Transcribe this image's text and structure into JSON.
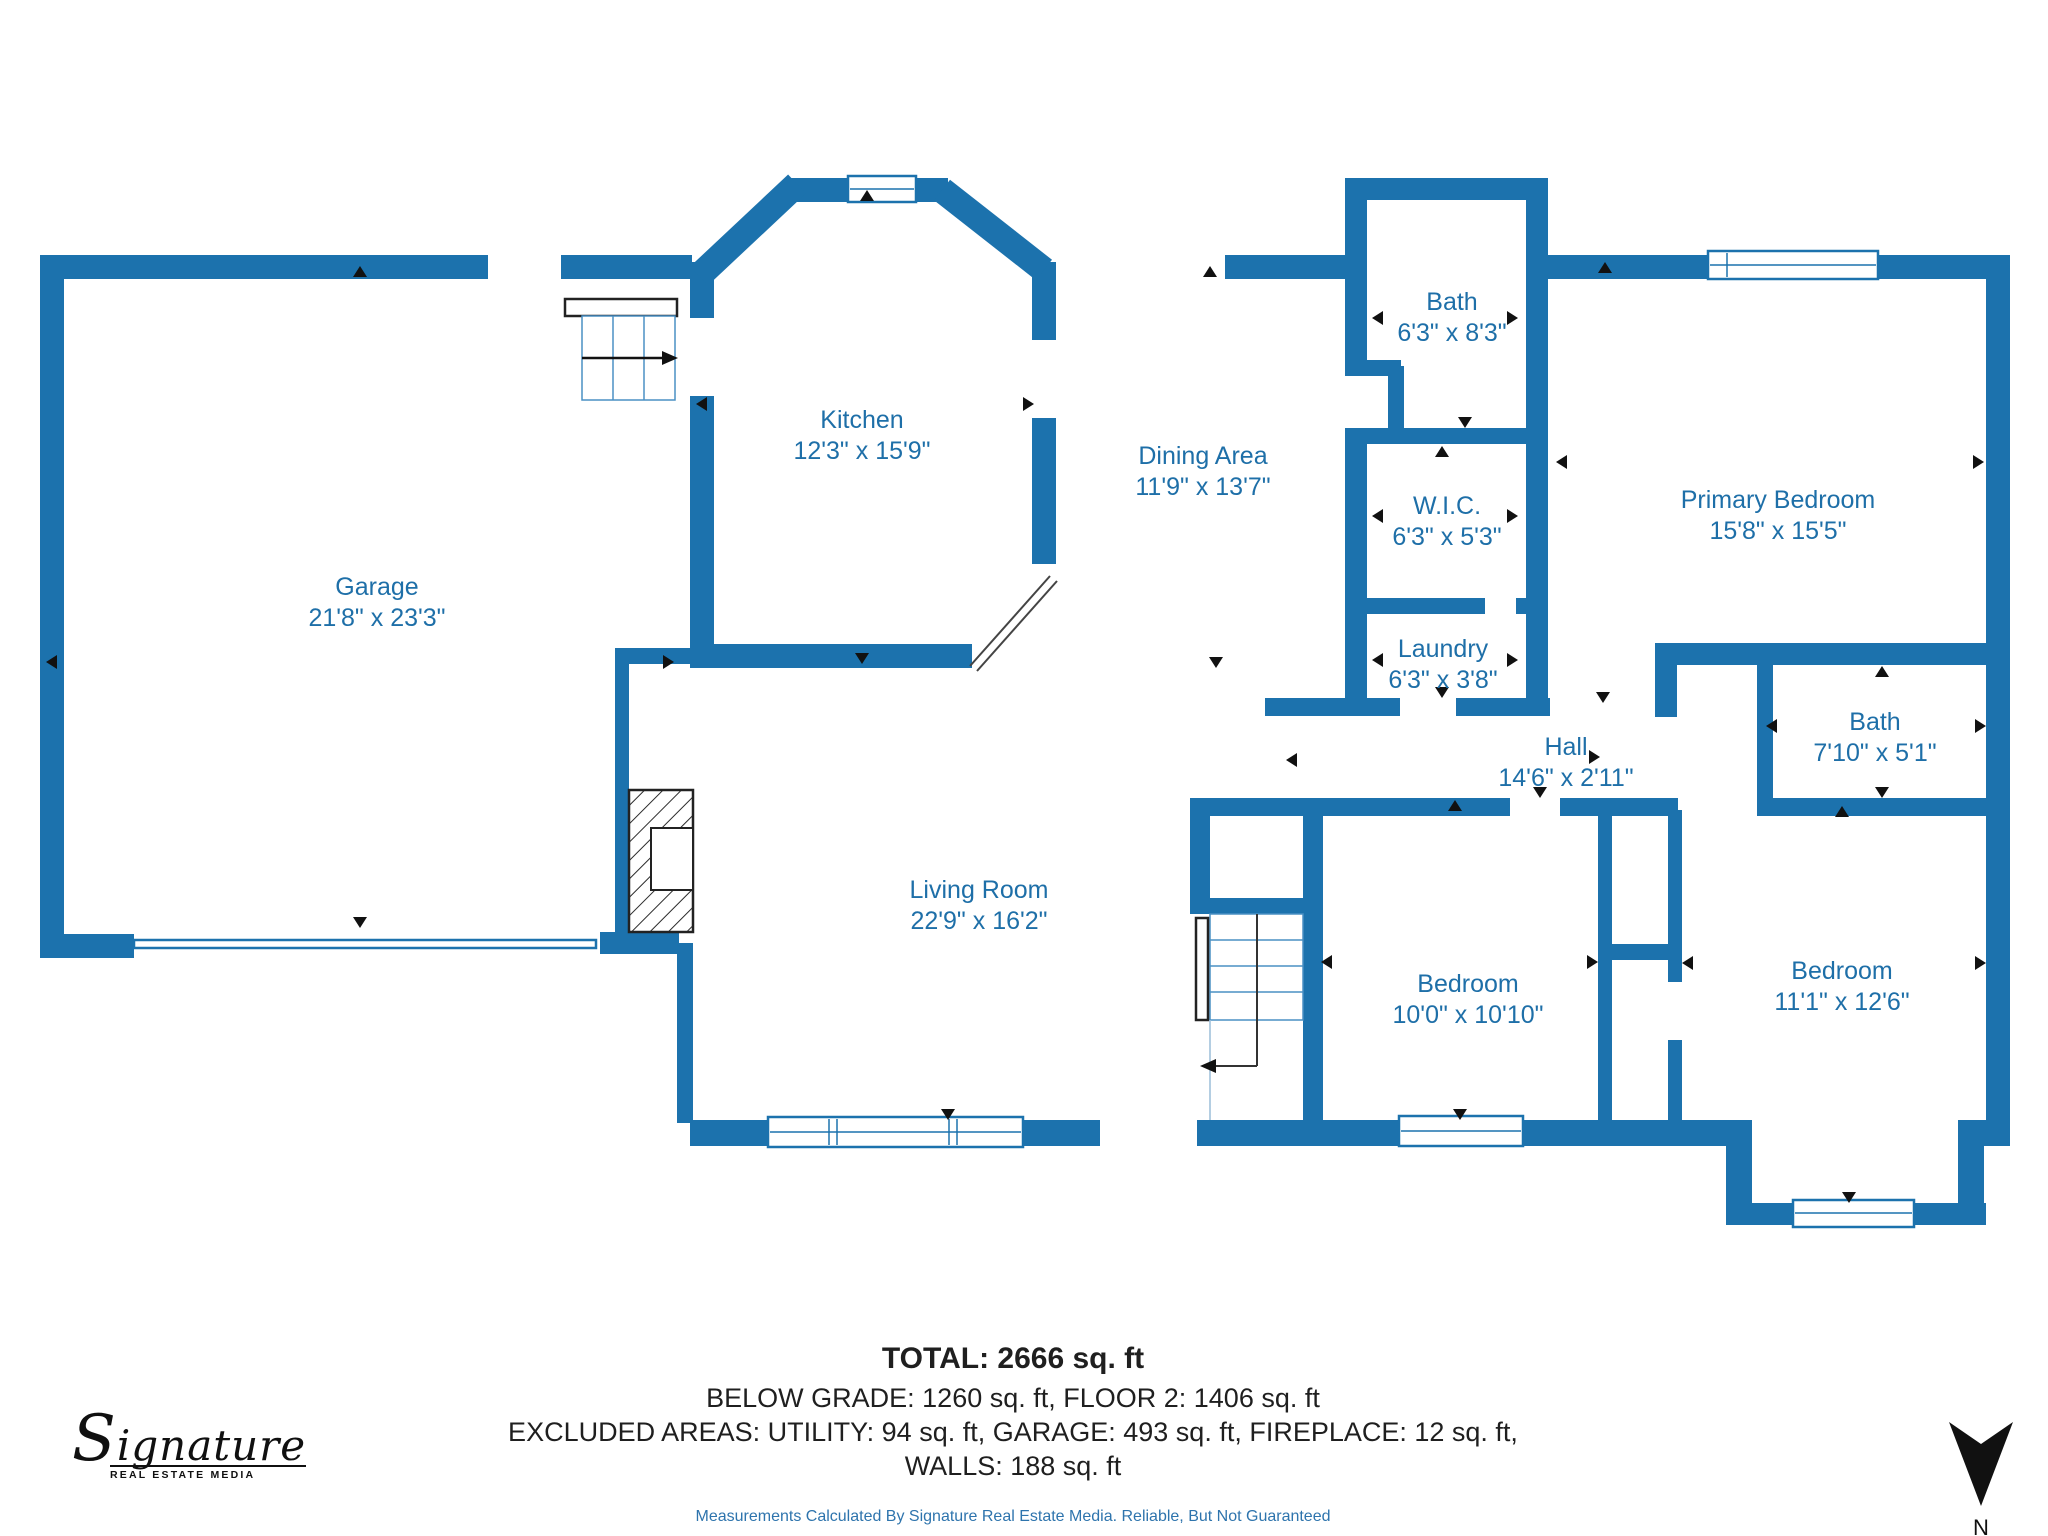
{
  "colors": {
    "wall_blue": "#1C72AD",
    "room_label_blue": "#1E6FA8",
    "footer_text": "#1f1f1f",
    "disclaimer_blue": "#2E74AD",
    "marker_black": "#111111"
  },
  "rooms": [
    {
      "name": "Garage",
      "dims": "21'8\" x 23'3\""
    },
    {
      "name": "Kitchen",
      "dims": "12'3\" x 15'9\""
    },
    {
      "name": "Dining Area",
      "dims": "11'9\" x 13'7\""
    },
    {
      "name": "Bath",
      "dims": "6'3\" x 8'3\""
    },
    {
      "name": "Primary Bedroom",
      "dims": "15'8\" x 15'5\""
    },
    {
      "name": "W.I.C.",
      "dims": "6'3\" x 5'3\""
    },
    {
      "name": "Laundry",
      "dims": "6'3\" x 3'8\""
    },
    {
      "name": "Hall",
      "dims": "14'6\" x 2'11\""
    },
    {
      "name": "Bath",
      "dims": "7'10\" x 5'1\""
    },
    {
      "name": "Living Room",
      "dims": "22'9\" x 16'2\""
    },
    {
      "name": "Bedroom",
      "dims": "10'0\" x 10'10\""
    },
    {
      "name": "Bedroom",
      "dims": "11'1\" x 12'6\""
    }
  ],
  "footer": {
    "total": "TOTAL: 2666 sq. ft",
    "line2": "BELOW GRADE: 1260 sq. ft, FLOOR 2: 1406 sq. ft",
    "line3": "EXCLUDED AREAS: UTILITY: 94 sq. ft, GARAGE: 493 sq. ft, FIREPLACE: 12 sq. ft,",
    "line4": "WALLS: 188 sq. ft",
    "disclaimer": "Measurements Calculated By Signature Real Estate Media. Reliable, But Not Guaranteed"
  },
  "logo": {
    "name": "Signature",
    "subtitle": "REAL ESTATE MEDIA"
  },
  "compass": {
    "label": "N"
  }
}
